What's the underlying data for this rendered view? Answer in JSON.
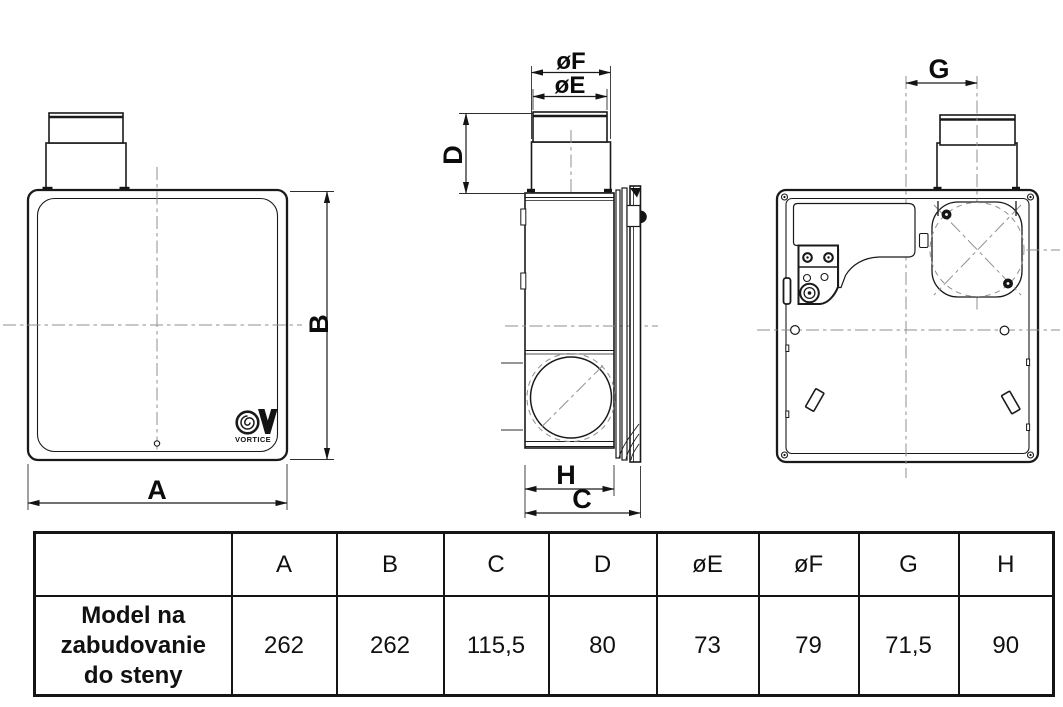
{
  "drawing": {
    "front_view": {
      "width_label": "A",
      "height_label": "B",
      "logo_text": "VORTICE"
    },
    "side_view": {
      "depth_label": "C",
      "duct_height_label": "D",
      "duct_inner_diameter_label": "øE",
      "duct_outer_diameter_label": "øF",
      "body_depth_label": "H"
    },
    "back_view": {
      "duct_offset_label": "G"
    }
  },
  "table": {
    "columns": [
      "A",
      "B",
      "C",
      "D",
      "øE",
      "øF",
      "G",
      "H"
    ],
    "rows": [
      {
        "label": "Model na zabudovanie do steny",
        "values": [
          "262",
          "262",
          "115,5",
          "80",
          "73",
          "79",
          "71,5",
          "90"
        ]
      }
    ]
  },
  "colors": {
    "line": "#1a1a1a",
    "centerline": "#8f8f8f",
    "background": "#ffffff"
  }
}
